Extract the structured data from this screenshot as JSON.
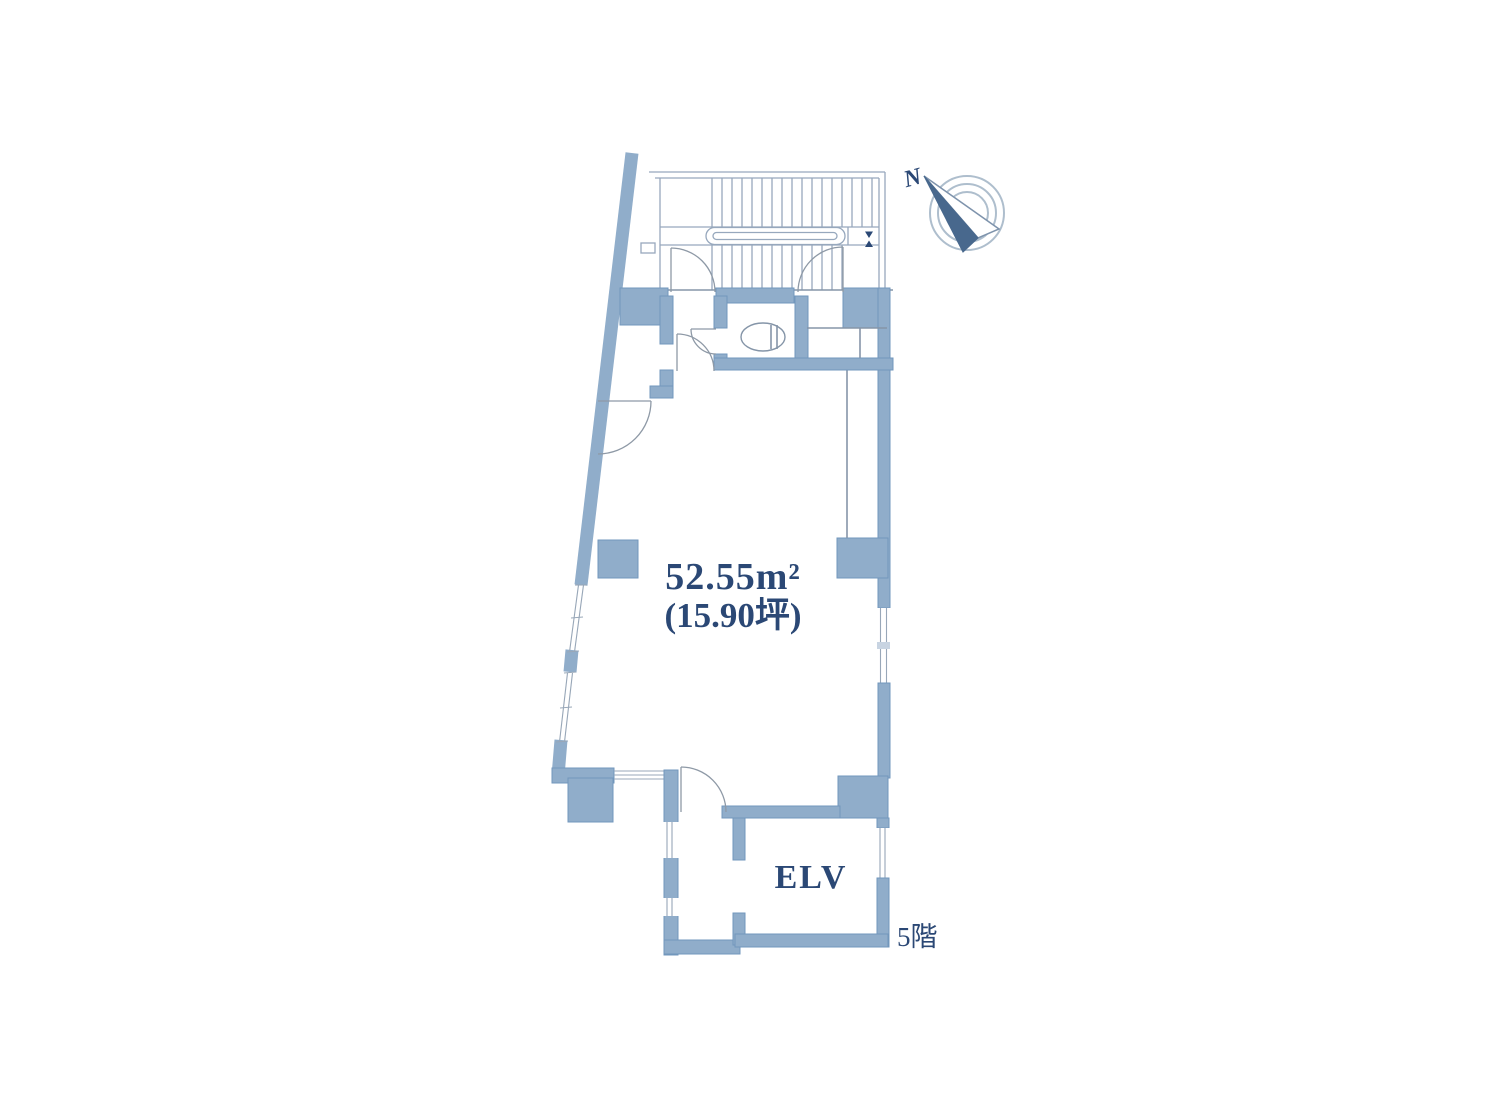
{
  "page": {
    "background": "#ffffff"
  },
  "floor_plan": {
    "labels": {
      "area": "52.55m²",
      "tsubo": "(15.90坪)",
      "elevator": "ELV",
      "floor": "5階",
      "compass_north": "N"
    },
    "colors": {
      "wall": "#90ADCA",
      "wall_border": "#7297BC",
      "thin_line": "#8595A8",
      "stair_line": "#97A8BD",
      "door_line": "#8E99A6",
      "glaze": "#98A7B8",
      "text": "#2B4875",
      "ring": "#AEBECD",
      "needle_dark": "#48688D"
    }
  }
}
